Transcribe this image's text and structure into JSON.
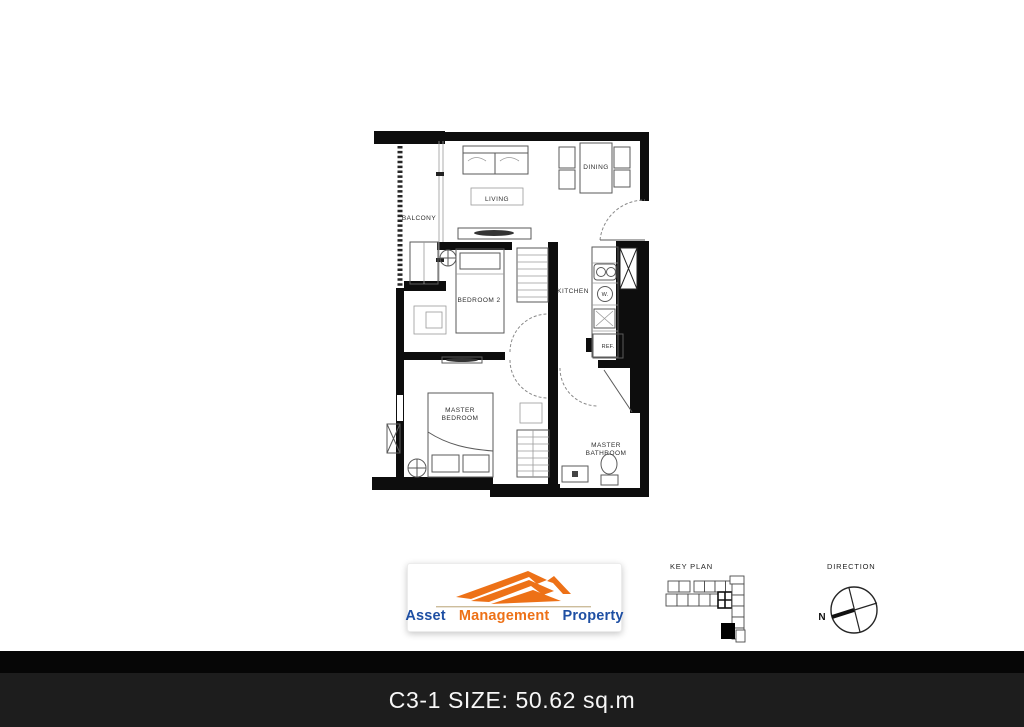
{
  "floor_plan": {
    "rooms": {
      "balcony": "BALCONY",
      "living": "LIVING",
      "dining": "DINING",
      "kitchen": "KITCHEN",
      "bedroom2": "BEDROOM 2",
      "master_bedroom": [
        "MASTER",
        "BEDROOM"
      ],
      "master_bathroom": [
        "MASTER",
        "BATHROOM"
      ],
      "fridge": "REF.",
      "washer": "W."
    }
  },
  "key_plan": {
    "title": "KEY PLAN"
  },
  "direction": {
    "title": "DIRECTION",
    "north": "N"
  },
  "logo": {
    "words": [
      "Asset",
      "Management",
      "Property"
    ],
    "blue": "#1E4FA3",
    "orange": "#ED7117"
  },
  "footer": {
    "label": "C3-1 SIZE: 50.62 sq.m",
    "bar_color": "#1d1d1d"
  }
}
